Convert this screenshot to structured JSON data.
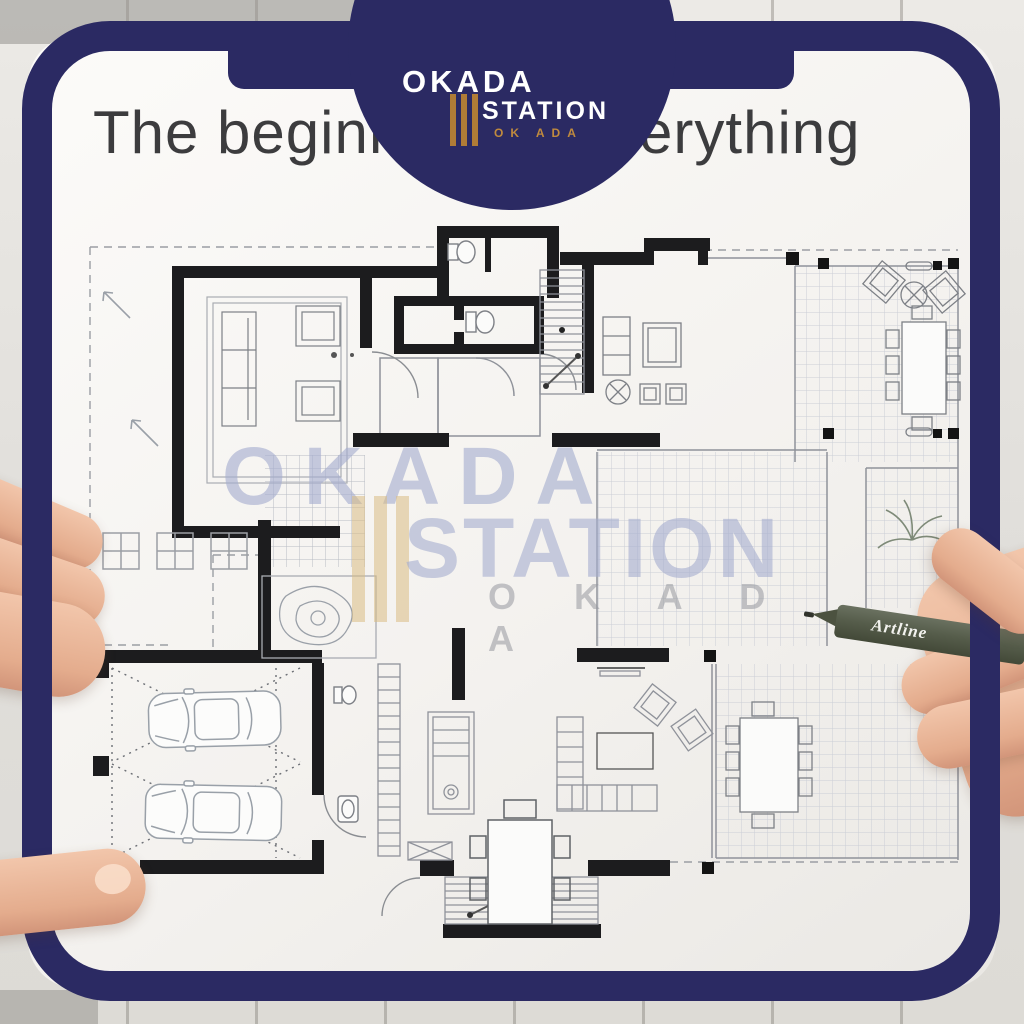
{
  "poster": {
    "headline": "The beginning of everything"
  },
  "brand": {
    "name_top": "OKADA",
    "name_mid": "STATION",
    "name_sub": "OK ADA"
  },
  "watermark": {
    "name_top": "OKADA",
    "name_mid": "STATION",
    "name_sub": "O K A D A"
  },
  "pen": {
    "brand": "Artline"
  },
  "colors": {
    "frame_navy": "#2b2a63",
    "brand_gold": "#b07c36",
    "watermark_blue": "#c4c9de",
    "watermark_gold": "#e7d8b8",
    "paper": "#f7f6f2",
    "plan_ink": "#1c1c1e",
    "pen_green": "#59614d"
  }
}
